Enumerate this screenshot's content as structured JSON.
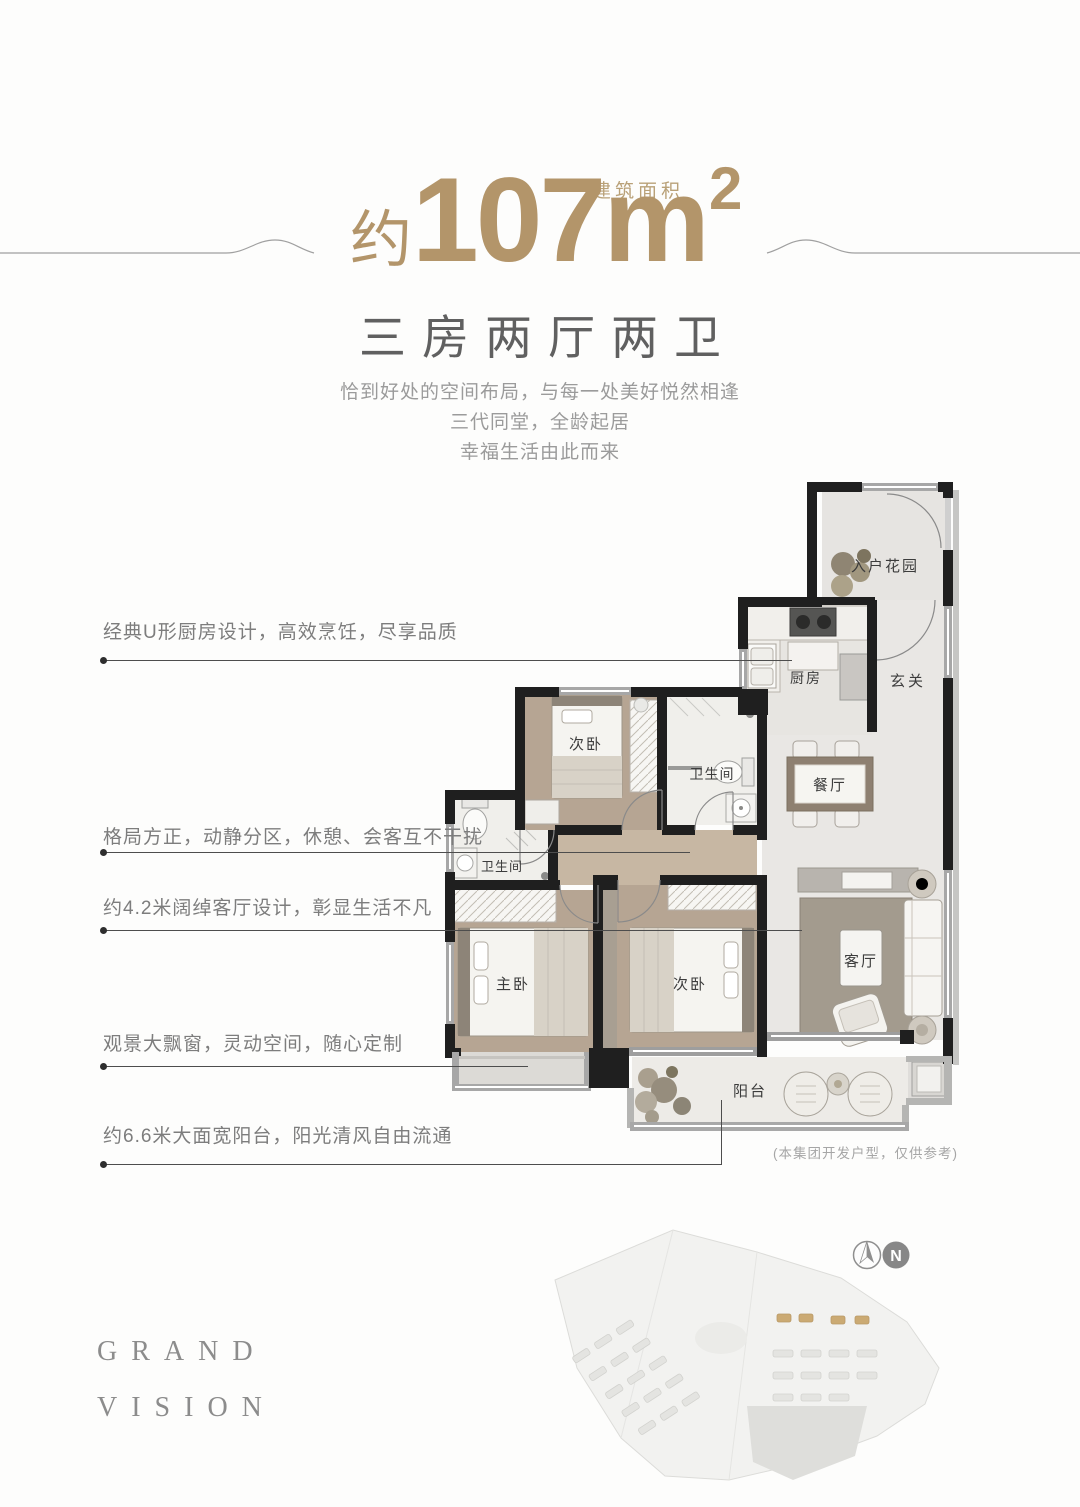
{
  "header": {
    "area_prefix": "约",
    "area_number": "107m",
    "area_superscript": "2",
    "area_label": "建筑面积",
    "layout_title": "三房两厅两卫",
    "taglines": [
      "恰到好处的空间布局，与每一处美好悦然相逢",
      "三代同堂，全龄起居",
      "幸福生活由此而来"
    ]
  },
  "callouts": [
    {
      "text": "经典U形厨房设计，高效烹饪，尽享品质"
    },
    {
      "text": "格局方正，动静分区，休憩、会客互不干扰"
    },
    {
      "text": "约4.2米阔绰客厅设计，彰显生活不凡"
    },
    {
      "text": "观景大飘窗，灵动空间，随心定制"
    },
    {
      "text": "约6.6米大面宽阳台，阳光清风自由流通"
    }
  ],
  "floorplan": {
    "rooms": {
      "entry_garden": "入户花园",
      "foyer": "玄关",
      "kitchen": "厨房",
      "dining": "餐厅",
      "bedroom2": "次卧",
      "bath1": "卫生间",
      "bath2": "卫生间",
      "master": "主卧",
      "bedroom3": "次卧",
      "living": "客厅",
      "balcony": "阳台"
    },
    "disclaimer": "(本集团开发户型，仅供参考)"
  },
  "footer": {
    "brand_top": "GRAND",
    "brand_bottom": "VISION",
    "compass_n": "N"
  },
  "colors": {
    "gold": "#b3956a",
    "title_gray": "#606060",
    "text_gray": "#9b9b9b",
    "wall_black": "#1f1f1f"
  }
}
